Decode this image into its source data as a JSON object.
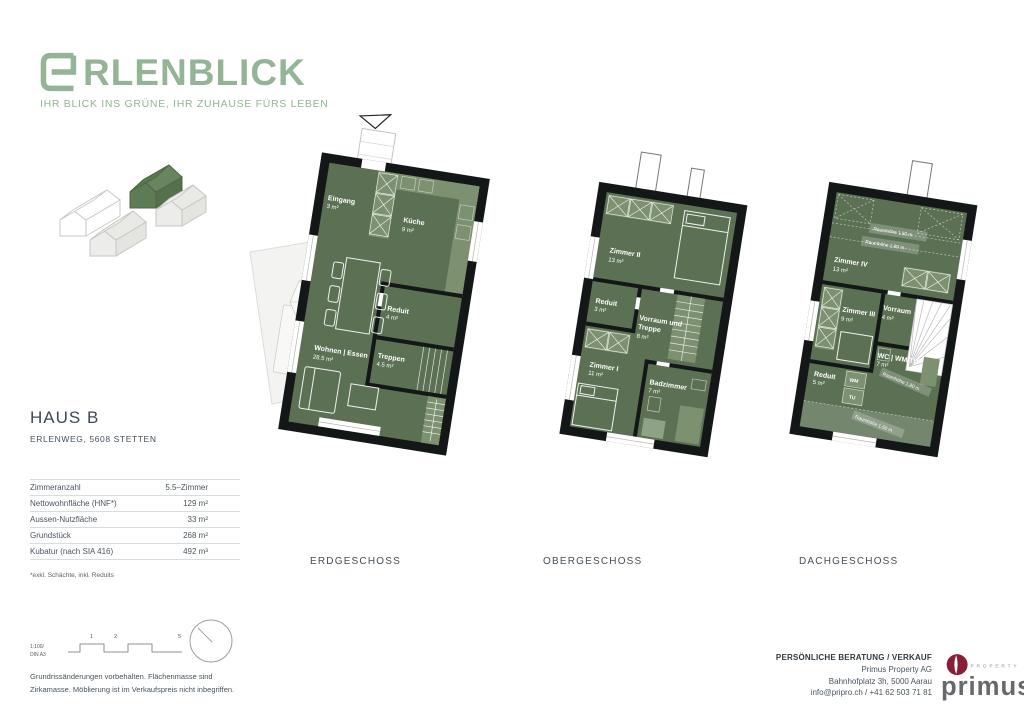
{
  "brand": {
    "name": "ERLENBLICK",
    "logo_text": "RLENBLICK",
    "tagline": "IHR BLICK INS GRÜNE, IHR ZUHAUSE FÜRS LEBEN"
  },
  "property": {
    "title": "HAUS B",
    "address": "ERLENWEG, 5608 STETTEN",
    "specs": [
      {
        "label": "Zimmeranzahl",
        "value": "5.5–Zimmer"
      },
      {
        "label": "Nettowohnfläche (HNF*)",
        "value": "129 m²"
      },
      {
        "label": "Aussen-Nutzfläche",
        "value": "33 m²"
      },
      {
        "label": "Grundstück",
        "value": "268 m²"
      },
      {
        "label": "Kubatur (nach SIA 416)",
        "value": "492 m³"
      }
    ],
    "footnote": "*exkl. Schächte, inkl. Reduits"
  },
  "floors": [
    {
      "label": "ERDGESCHOSS",
      "rooms": [
        {
          "name": "Eingang",
          "area": "3 m²"
        },
        {
          "name": "Küche",
          "area": "9 m²"
        },
        {
          "name": "Reduit",
          "area": "4 m²"
        },
        {
          "name": "Treppen",
          "area": "4.5 m²"
        },
        {
          "name": "Wohnen | Essen",
          "area": "28.5 m²"
        }
      ]
    },
    {
      "label": "OBERGESCHOSS",
      "rooms": [
        {
          "name": "Zimmer II",
          "area": "13 m²"
        },
        {
          "name": "Reduit",
          "area": "3 m²"
        },
        {
          "name": "Vorraum und",
          "name2": "Treppe",
          "area": "8 m²"
        },
        {
          "name": "Zimmer I",
          "area": "11 m²"
        },
        {
          "name": "Badzimmer",
          "area": "7 m²"
        }
      ]
    },
    {
      "label": "DACHGESCHOSS",
      "annotations": [
        "Raumhöhe 1.50 m",
        "Raumhöhe 1.80 m",
        "Raumhöhe 1.80 m",
        "Raumhöhe 1.50 m"
      ],
      "rooms": [
        {
          "name": "Zimmer IV",
          "area": "13 m²"
        },
        {
          "name": "Zimmer III",
          "area": "9 m²"
        },
        {
          "name": "Vorraum",
          "area": "4 m²"
        },
        {
          "name": "WC | WM/TU",
          "area": "7 m²"
        },
        {
          "name": "Reduit",
          "area": "5 m²"
        },
        {
          "name": "WM"
        },
        {
          "name": "TU"
        }
      ]
    }
  ],
  "scale": {
    "line1": "1:100/",
    "line2": "DIN A3",
    "marks": [
      "1",
      "2",
      "5"
    ]
  },
  "disclaimer": {
    "line1": "Grundrissänderungen vorbehalten. Flächenmasse sind",
    "line2": "Zirkamasse. Möblierung ist im Verkaufspreis nicht inbegriffen."
  },
  "contact": {
    "heading": "PERSÖNLICHE BERATUNG / VERKAUF",
    "company": "Primus Property AG",
    "address": "Bahnhofplatz 3h, 5000 Aarau",
    "phone_line": "info@pripro.ch / +41 62 503 71 81"
  },
  "agency_logo": {
    "name": "primus",
    "property_label": "PROPERTY"
  },
  "colors": {
    "brand_green": "#93b495",
    "plan_room_green": "#5c7154",
    "plan_light_green": "#7d9070",
    "plan_wall": "#141718",
    "primus_red": "#8a1e38",
    "text_dark": "#3d4852"
  }
}
